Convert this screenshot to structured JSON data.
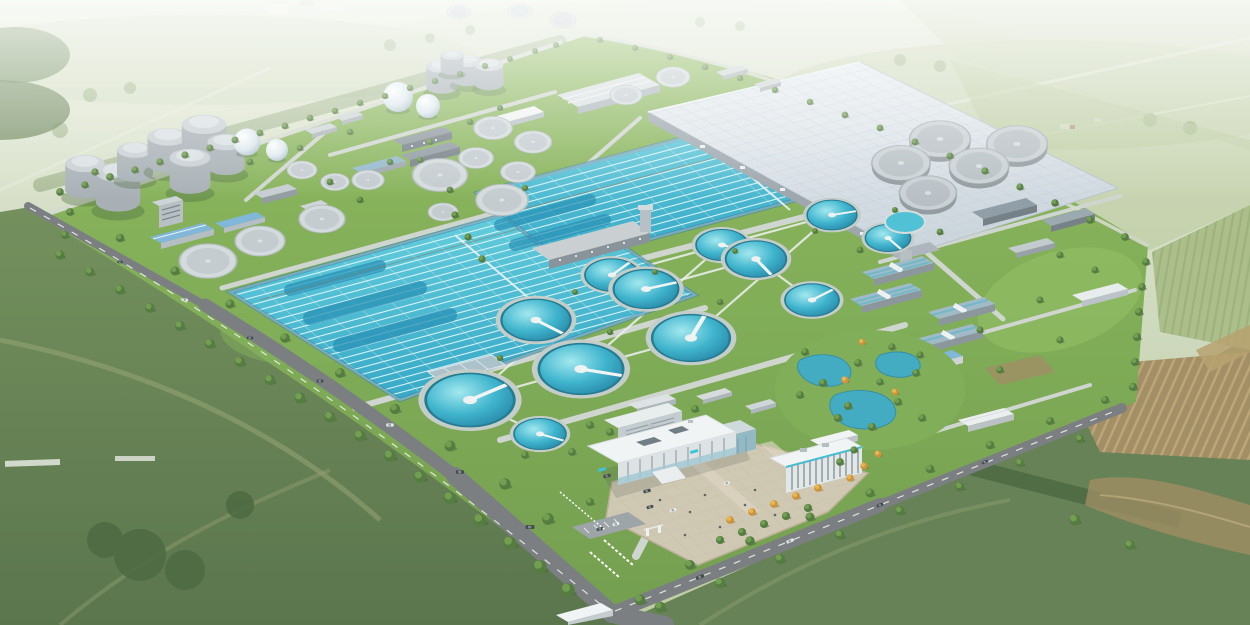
{
  "scene": {
    "title": "Wastewater Treatment Plant — Aerial Rendering",
    "medium": "3D architectural visualization, bird's-eye view",
    "subject": "Large wastewater treatment plant campus set in green farmland with tree-lined perimeter roads, hazy horizon at top and open fields in the foreground",
    "facility_zones": [
      {
        "id": "digester-cluster",
        "label": "Sludge digester tanks and white gas-holder spheres"
      },
      {
        "id": "aeration-basins",
        "label": "Two large rectangular aeration basins with teal water lanes"
      },
      {
        "id": "covered-treatment-basin",
        "label": "Large covered treatment basin with light paneled roof"
      },
      {
        "id": "clarifier-field",
        "label": "Grid of circular clarifiers with white access bridges"
      },
      {
        "id": "covered-circular-tanks",
        "label": "Cluster of gray covered circular tanks"
      },
      {
        "id": "process-buildings",
        "label": "Process, blower and workshop buildings with blue and slate roofs"
      },
      {
        "id": "admin-complex",
        "label": "White administration building, laboratory and paved entrance plaza"
      },
      {
        "id": "landscape-pond",
        "label": "Landscaped garden with winding ponds and autumn trees"
      },
      {
        "id": "perimeter-roads",
        "label": "Tree-lined perimeter roads with vehicles and entrance junction"
      },
      {
        "id": "farmland",
        "label": "Surrounding crop fields, hedgerows, furrowed plots and dirt tracks"
      }
    ]
  },
  "colors": {
    "haze_sky": "#dfe5d2",
    "distant_field": "#c3d0ab",
    "field_olive": "#6e8b55",
    "field_dark": "#536e45",
    "hedge_green": "#46633a",
    "grass_bright": "#87b558",
    "grass_mid": "#6d9b48",
    "tree_green": "#4d7538",
    "tree_autumn": "#d2912f",
    "water_teal": "#3bb9d4",
    "water_deep": "#1b7fa2",
    "lane_line": "#e2f8fa",
    "road_asphalt": "#75797c",
    "road_internal": "#cfd5cf",
    "road_dash": "#f4f6f2",
    "roof_white": "#f3f5f6",
    "roof_blue": "#7cb4d8",
    "roof_slate": "#8c9aa4",
    "roof_covered": "#dde4eb",
    "tank_gray": "#c9cfd4",
    "wall_gray": "#aab3b9",
    "plaza_tan": "#cfc6b1",
    "pond_teal": "#3aa8c2",
    "sphere_white": "#eef3f6",
    "farm_brown": "#a08a5e"
  }
}
